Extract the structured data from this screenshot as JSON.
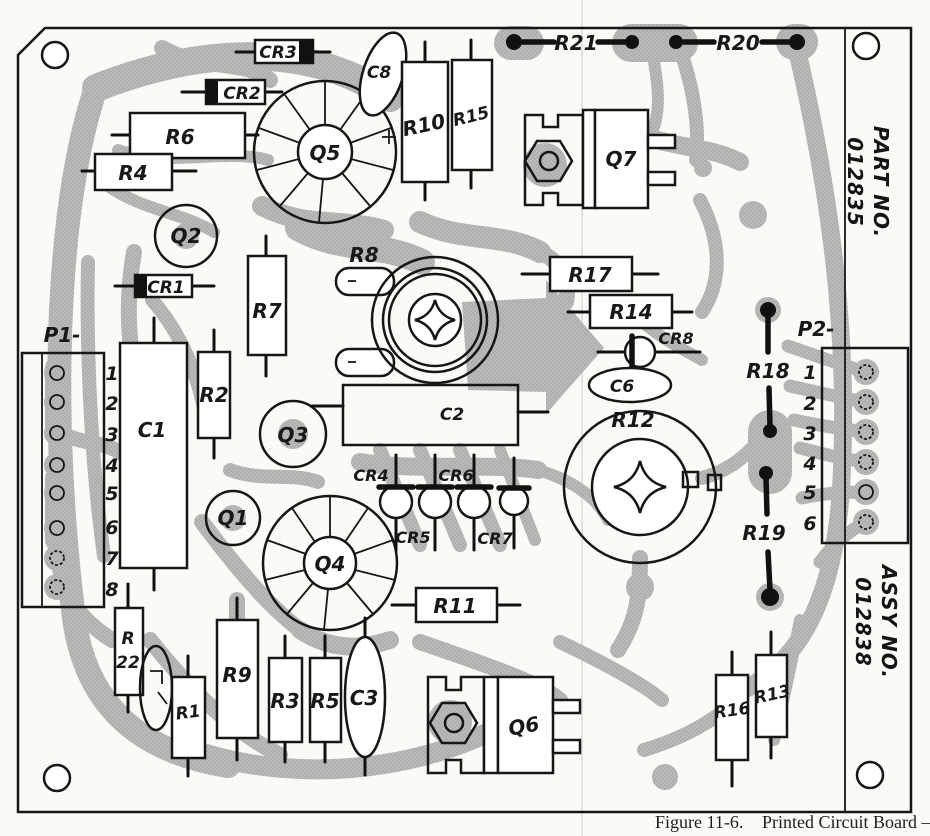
{
  "caption": {
    "figure": "Figure 11-6.",
    "title": "Printed Circuit Board —"
  },
  "annotations": {
    "part_no_label": "PART NO.",
    "part_no_value": "012835",
    "assy_no_label": "ASSY NO.",
    "assy_no_value": "012838"
  },
  "connectors": {
    "p1": {
      "label": "P1-",
      "pins": [
        "1",
        "2",
        "3",
        "4",
        "5",
        "6",
        "7",
        "8"
      ]
    },
    "p2": {
      "label": "P2-",
      "pins": [
        "1",
        "2",
        "3",
        "4",
        "5",
        "6"
      ]
    }
  },
  "labels": {
    "r1": "R1",
    "r2": "R2",
    "r3": "R3",
    "r4": "R4",
    "r5": "R5",
    "r6": "R6",
    "r7": "R7",
    "r8": "R8",
    "r9": "R9",
    "r10": "R10",
    "r11": "R11",
    "r12": "R12",
    "r13": "R13",
    "r14": "R14",
    "r15": "R15",
    "r16": "R16",
    "r17": "R17",
    "r18": "R18",
    "r19": "R19",
    "r20": "R20",
    "r21": "R21",
    "r22_top": "R",
    "r22_bottom": "22",
    "c1": "C1",
    "c2": "C2",
    "c3": "C3",
    "c6": "C6",
    "c8": "C8",
    "cr1": "CR1",
    "cr2": "CR2",
    "cr3": "CR3",
    "cr4": "CR4",
    "cr5": "CR5",
    "cr6": "CR6",
    "cr7": "CR7",
    "cr8": "CR8",
    "q1": "Q1",
    "q2": "Q2",
    "q3": "Q3",
    "q4": "Q4",
    "q5": "Q5",
    "q6": "Q6",
    "q7": "Q7"
  },
  "colors": {
    "trace": "#b9b9b9",
    "trace_dot": "#a3a3a3",
    "ink": "#161616",
    "paper": "#fbfaf6"
  }
}
